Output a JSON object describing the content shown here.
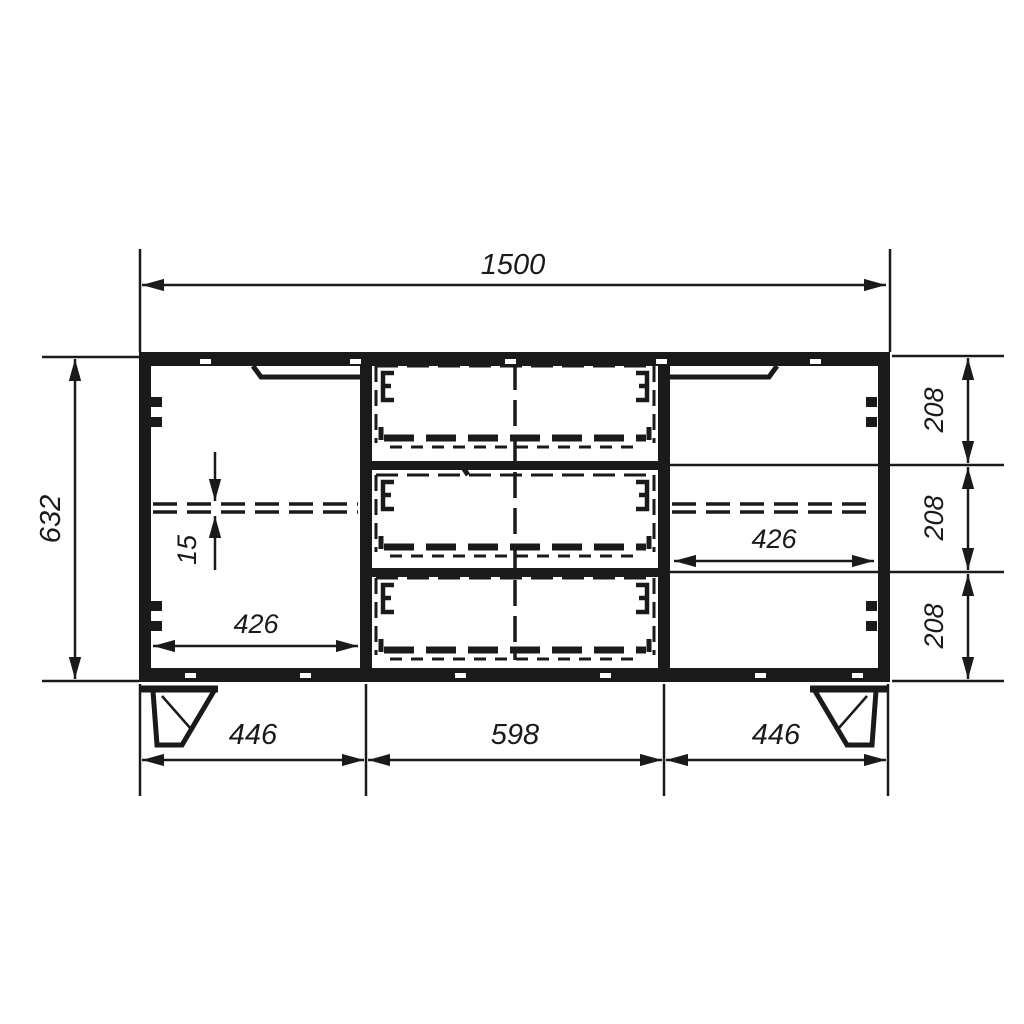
{
  "drawing": {
    "type": "cabinet-front-view-dimension-drawing",
    "line_color": "#1a1a1a",
    "background_color": "#ffffff",
    "dims": {
      "overall_width": "1500",
      "overall_height": "632",
      "drawer_heights": [
        "208",
        "208",
        "208"
      ],
      "left_compartment_inner_width": "426",
      "right_compartment_inner_width": "426",
      "shelf_thickness": "15",
      "bottom_sections": [
        "446",
        "598",
        "446"
      ]
    }
  }
}
